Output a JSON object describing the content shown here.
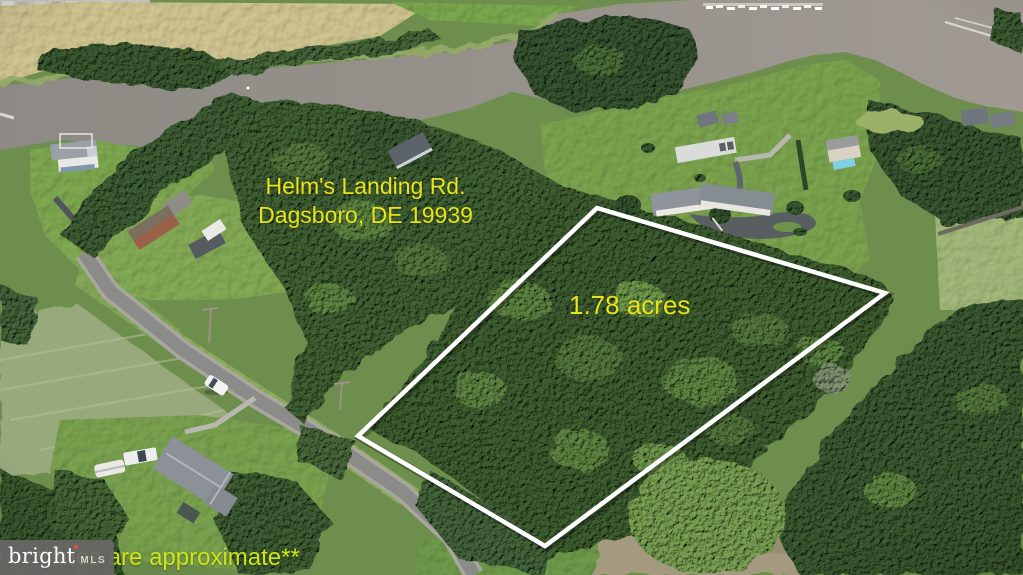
{
  "listing": {
    "address_line1": "Helm's Landing Rd.",
    "address_line2": "Dagsboro, DE 19939",
    "lot_size": "1.78 acres",
    "disclaimer": "**lines are approximate**"
  },
  "watermark": {
    "brand": "bright",
    "brand_suffix": "MLS"
  },
  "colors": {
    "annotation_yellow": "#e8e31b",
    "disclaimer_yellow": "#cfe31a",
    "boundary_white": "#ffffff",
    "watermark_bg": "#686765",
    "watermark_accent": "#e4572e"
  }
}
